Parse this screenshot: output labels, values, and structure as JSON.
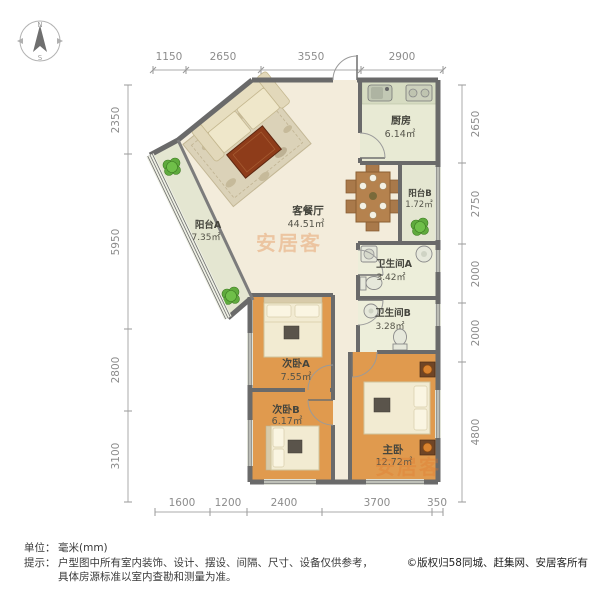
{
  "compass": {
    "north": "N",
    "south": "S"
  },
  "dimensions": {
    "top": [
      "1150",
      "2650",
      "3550",
      "2900"
    ],
    "left": [
      "2350",
      "5950",
      "2800",
      "3100"
    ],
    "right": [
      "2650",
      "2750",
      "2000",
      "2000",
      "4800"
    ],
    "bottom": [
      "1600",
      "1200",
      "2400",
      "3700",
      "350"
    ]
  },
  "rooms": {
    "living": {
      "name": "客餐厅",
      "area": "44.51㎡"
    },
    "kitchen": {
      "name": "厨房",
      "area": "6.14㎡"
    },
    "balcony_a": {
      "name": "阳台A",
      "area": "7.35㎡"
    },
    "balcony_b": {
      "name": "阳台B",
      "area": "1.72㎡"
    },
    "bath_a": {
      "name": "卫生间A",
      "area": "3.42㎡"
    },
    "bath_b": {
      "name": "卫生间B",
      "area": "3.28㎡"
    },
    "bedroom_a": {
      "name": "次卧A",
      "area": "7.55㎡"
    },
    "bedroom_b": {
      "name": "次卧B",
      "area": "6.17㎡"
    },
    "master": {
      "name": "主卧",
      "area": "12.72㎡"
    }
  },
  "watermarks": {
    "center": "安居客",
    "bottom": "安居客"
  },
  "footer": {
    "unit_label": "单位：",
    "unit_value": "毫米(mm)",
    "note_label": "提示：",
    "note_line1": "户型图中所有室内装饰、设计、摆设、间隔、尺寸、设备仅供参考，",
    "note_line2": "具体房源标准以室内查勘和测量为准。",
    "copyright": "©版权归58同城、赶集网、安居客所有"
  },
  "colors": {
    "wall": "#6a6a6a",
    "inner_wall": "#7c7c7c",
    "living_floor": "#f3ecdb",
    "bedroom_floor": "#e09a4e",
    "kitchen_floor": "#e8ead4",
    "bath_floor": "#edeeda",
    "balcony_floor": "#e4e6d1",
    "watermark": "#e0762a"
  }
}
